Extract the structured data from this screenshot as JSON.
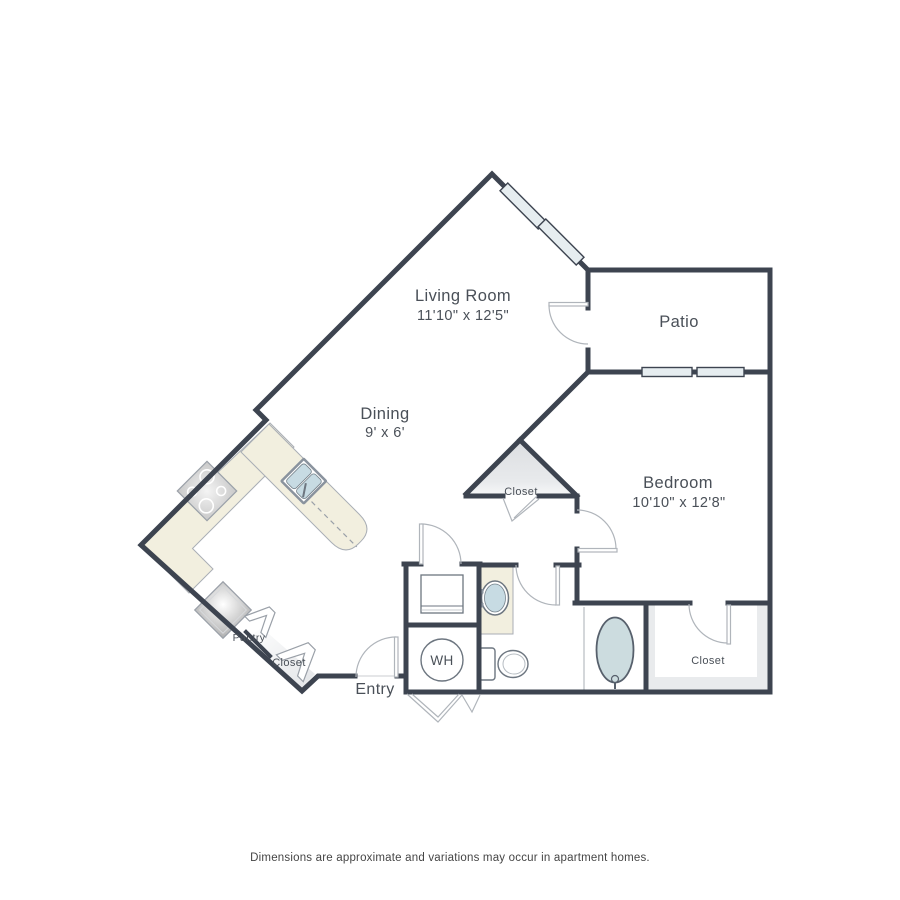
{
  "rooms": {
    "living_room": {
      "name": "Living Room",
      "dims": "11'10\" x 12'5\""
    },
    "dining": {
      "name": "Dining",
      "dims": "9' x 6'"
    },
    "patio": {
      "name": "Patio"
    },
    "bedroom": {
      "name": "Bedroom",
      "dims": "10'10\" x 12'8\""
    }
  },
  "labels": {
    "hall_closet": "Closet",
    "bedroom_closet": "Closet",
    "entry_closet": "Closet",
    "pantry": "Pantry",
    "entry": "Entry",
    "water_heater": "WH"
  },
  "disclaimer": "Dimensions are approximate and variations may occur in apartment homes.",
  "colors": {
    "wall": "#3d4450",
    "counter": "#f2efdf",
    "fixture_blue": "#c7dbe3",
    "window_blue": "#e6edf0",
    "closet_gray": "#e9ebed",
    "door_line": "#b0b5bb",
    "fixture_line": "#6d7680",
    "text": "#4a5058"
  }
}
